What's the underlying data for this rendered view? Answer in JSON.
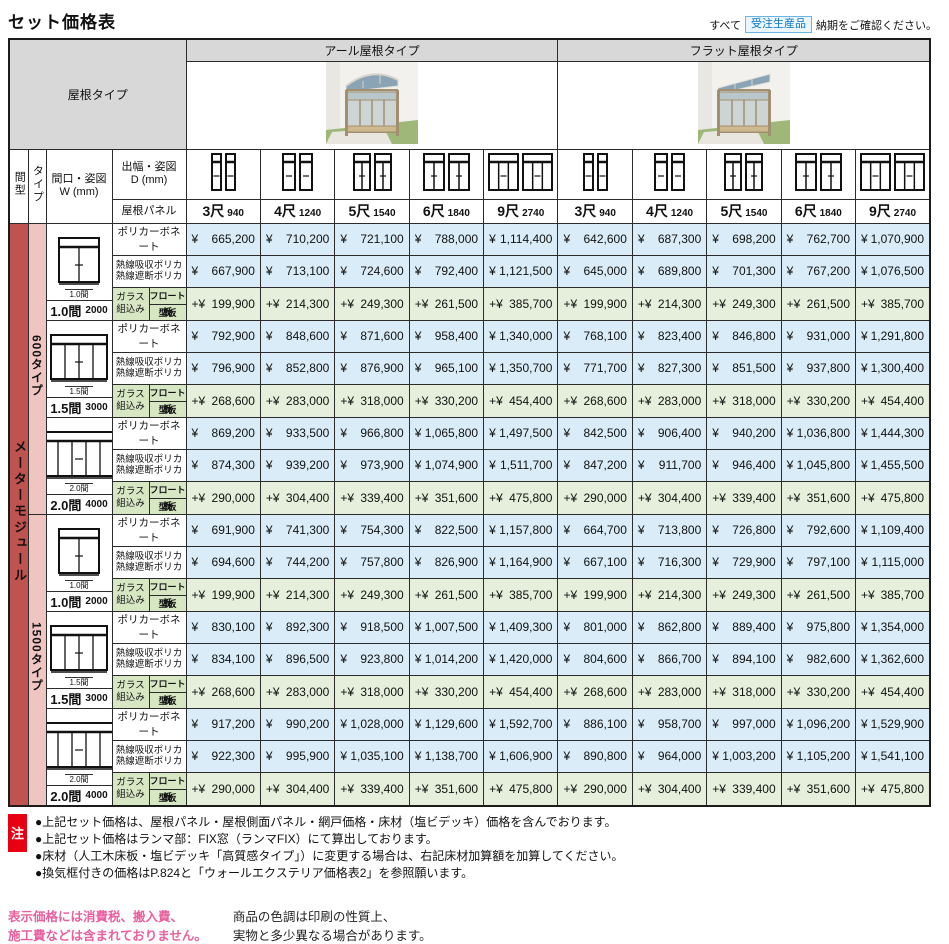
{
  "page": {
    "title": "セット価格表",
    "order_note": {
      "prefix": "すべて",
      "badge": "受注生産品",
      "suffix": "納期をご確認ください。"
    }
  },
  "colors": {
    "price_bg": "#d9ecf7",
    "add_bg": "#e5efdb",
    "glass_label_bg": "#d7e7c4",
    "bay_bg": "#bf5350",
    "type_bg": "#efc5c2",
    "header_bg": "#d8d8d8",
    "note_red": "#e60012",
    "badge_blue": "#0b76c0",
    "pink_text": "#e8609f"
  },
  "table": {
    "corner_label": "屋根タイプ",
    "roof_types": [
      "アール屋根タイプ",
      "フラット屋根タイプ"
    ],
    "headers": {
      "bay": "間型",
      "type": "タイプ",
      "width1": "間口・姿図",
      "width2": "W (mm)",
      "depth1": "出幅・姿図",
      "depth2": "D (mm)",
      "roof_panel": "屋根パネル"
    },
    "bay_module": "メーターモジュール",
    "sizes": [
      {
        "shaku": "3尺",
        "mm": "940",
        "icon": {
          "unitW": 11,
          "panes": 1
        }
      },
      {
        "shaku": "4尺",
        "mm": "1240",
        "icon": {
          "unitW": 14,
          "panes": 1
        }
      },
      {
        "shaku": "5尺",
        "mm": "1540",
        "icon": {
          "unitW": 18,
          "panes": 2
        }
      },
      {
        "shaku": "6尺",
        "mm": "1840",
        "icon": {
          "unitW": 22,
          "panes": 2
        }
      },
      {
        "shaku": "9尺",
        "mm": "2740",
        "icon": {
          "unitW": 31,
          "panes": 3
        }
      }
    ],
    "panel_labels": {
      "poly": "ポリカーボネート",
      "heat1": "熱線吸収ポリカ",
      "heat2": "熱線遮断ポリカ",
      "glass1": "ガラス",
      "glass2": "組込み",
      "float": "フロート板",
      "kata": "型板"
    },
    "price_prefix": "¥",
    "add_prefix": "+¥",
    "groups": [
      {
        "type": "600タイプ",
        "widths": [
          {
            "label": "1.0間",
            "mm": "2000",
            "diagram": {
              "panes": 2,
              "w": 40
            },
            "poly": {
              "arch": [
                "665,200",
                "710,200",
                "721,100",
                "788,000",
                "1,114,400"
              ],
              "flat": [
                "642,600",
                "687,300",
                "698,200",
                "762,700",
                "1,070,900"
              ]
            },
            "heat": {
              "arch": [
                "667,900",
                "713,100",
                "724,600",
                "792,400",
                "1,121,500"
              ],
              "flat": [
                "645,000",
                "689,800",
                "701,300",
                "767,200",
                "1,076,500"
              ]
            },
            "glass": {
              "arch": [
                "199,900",
                "214,300",
                "249,300",
                "261,500",
                "385,700"
              ],
              "flat": [
                "199,900",
                "214,300",
                "249,300",
                "261,500",
                "385,700"
              ]
            }
          },
          {
            "label": "1.5間",
            "mm": "3000",
            "diagram": {
              "panes": 4,
              "w": 56
            },
            "poly": {
              "arch": [
                "792,900",
                "848,600",
                "871,600",
                "958,400",
                "1,340,000"
              ],
              "flat": [
                "768,100",
                "823,400",
                "846,800",
                "931,000",
                "1,291,800"
              ]
            },
            "heat": {
              "arch": [
                "796,900",
                "852,800",
                "876,900",
                "965,100",
                "1,350,700"
              ],
              "flat": [
                "771,700",
                "827,300",
                "851,500",
                "937,800",
                "1,300,400"
              ]
            },
            "glass": {
              "arch": [
                "268,600",
                "283,000",
                "318,000",
                "330,200",
                "454,400"
              ],
              "flat": [
                "268,600",
                "283,000",
                "318,000",
                "330,200",
                "454,400"
              ]
            }
          },
          {
            "label": "2.0間",
            "mm": "4000",
            "diagram": {
              "panes": 5,
              "w": 70
            },
            "poly": {
              "arch": [
                "869,200",
                "933,500",
                "966,800",
                "1,065,800",
                "1,497,500"
              ],
              "flat": [
                "842,500",
                "906,400",
                "940,200",
                "1,036,800",
                "1,444,300"
              ]
            },
            "heat": {
              "arch": [
                "874,300",
                "939,200",
                "973,900",
                "1,074,900",
                "1,511,700"
              ],
              "flat": [
                "847,200",
                "911,700",
                "946,400",
                "1,045,800",
                "1,455,500"
              ]
            },
            "glass": {
              "arch": [
                "290,000",
                "304,400",
                "339,400",
                "351,600",
                "475,800"
              ],
              "flat": [
                "290,000",
                "304,400",
                "339,400",
                "351,600",
                "475,800"
              ]
            }
          }
        ]
      },
      {
        "type": "1500タイプ",
        "widths": [
          {
            "label": "1.0間",
            "mm": "2000",
            "diagram": {
              "panes": 2,
              "w": 40
            },
            "poly": {
              "arch": [
                "691,900",
                "741,300",
                "754,300",
                "822,500",
                "1,157,800"
              ],
              "flat": [
                "664,700",
                "713,800",
                "726,800",
                "792,600",
                "1,109,400"
              ]
            },
            "heat": {
              "arch": [
                "694,600",
                "744,200",
                "757,800",
                "826,900",
                "1,164,900"
              ],
              "flat": [
                "667,100",
                "716,300",
                "729,900",
                "797,100",
                "1,115,000"
              ]
            },
            "glass": {
              "arch": [
                "199,900",
                "214,300",
                "249,300",
                "261,500",
                "385,700"
              ],
              "flat": [
                "199,900",
                "214,300",
                "249,300",
                "261,500",
                "385,700"
              ]
            }
          },
          {
            "label": "1.5間",
            "mm": "3000",
            "diagram": {
              "panes": 4,
              "w": 56
            },
            "poly": {
              "arch": [
                "830,100",
                "892,300",
                "918,500",
                "1,007,500",
                "1,409,300"
              ],
              "flat": [
                "801,000",
                "862,800",
                "889,400",
                "975,800",
                "1,354,000"
              ]
            },
            "heat": {
              "arch": [
                "834,100",
                "896,500",
                "923,800",
                "1,014,200",
                "1,420,000"
              ],
              "flat": [
                "804,600",
                "866,700",
                "894,100",
                "982,600",
                "1,362,600"
              ]
            },
            "glass": {
              "arch": [
                "268,600",
                "283,000",
                "318,000",
                "330,200",
                "454,400"
              ],
              "flat": [
                "268,600",
                "283,000",
                "318,000",
                "330,200",
                "454,400"
              ]
            }
          },
          {
            "label": "2.0間",
            "mm": "4000",
            "diagram": {
              "panes": 5,
              "w": 70
            },
            "poly": {
              "arch": [
                "917,200",
                "990,200",
                "1,028,000",
                "1,129,600",
                "1,592,700"
              ],
              "flat": [
                "886,100",
                "958,700",
                "997,000",
                "1,096,200",
                "1,529,900"
              ]
            },
            "heat": {
              "arch": [
                "922,300",
                "995,900",
                "1,035,100",
                "1,138,700",
                "1,606,900"
              ],
              "flat": [
                "890,800",
                "964,000",
                "1,003,200",
                "1,105,200",
                "1,541,100"
              ]
            },
            "glass": {
              "arch": [
                "290,000",
                "304,400",
                "339,400",
                "351,600",
                "475,800"
              ],
              "flat": [
                "290,000",
                "304,400",
                "339,400",
                "351,600",
                "475,800"
              ]
            }
          }
        ]
      }
    ]
  },
  "notes": {
    "marker": "注",
    "items": [
      "●上記セット価格は、屋根パネル・屋根側面パネル・網戸価格・床材（塩ビデッキ）価格を含んでおります。",
      "●上記セット価格はランマ部：FIX窓（ランマFIX）にて算出しております。",
      "●床材（人工木床板・塩ビデッキ「高質感タイプ」）に変更する場合は、右記床材加算額を加算してください。",
      "●換気框付きの価格はP.824と「ウォールエクステリア価格表2」を参照願います。"
    ]
  },
  "footer": {
    "disclaimer": [
      "表示価格には消費税、搬入費、",
      "施工費などは含まれておりません。"
    ],
    "print_note": [
      "商品の色調は印刷の性質上、",
      "実物と多少異なる場合があります。"
    ]
  }
}
